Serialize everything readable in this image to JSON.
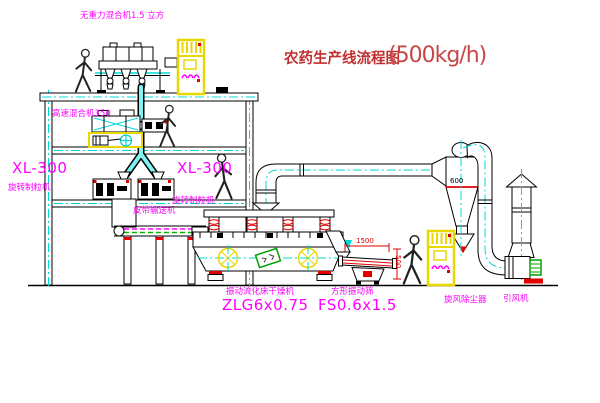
{
  "diagram": {
    "title": {
      "name": "农药生产线流程图",
      "capacity": "(500kg/h)"
    },
    "labels": {
      "gravity_mixer": "无重力混合机1.5 立方",
      "high_speed_mixer": "高速混合机350",
      "granulator_left": {
        "model": "XL-300",
        "name": "旋转制粒机"
      },
      "granulator_right": {
        "model": "XL-300",
        "name": "旋转制粒机"
      },
      "belt_conveyor": "皮带输送机",
      "fluid_bed_dryer": {
        "name": "振动流化床干燥机",
        "model": "ZLG6x0.75"
      },
      "square_sieve": {
        "name": "方形振动筛",
        "model": "FS0.6x1.5"
      },
      "cyclone": "旋风除尘器",
      "induced_draft_fan": "引风机"
    },
    "dimensions": {
      "cyclone_diameter": "600",
      "sieve_length": "1500",
      "sieve_height": "500"
    },
    "colors": {
      "label_magenta": "#FF00FF",
      "title_red": "#C03030",
      "centerline_cyan": "#00D8D8",
      "cabinet_yellow": "#E8D800",
      "accent_red": "#EE0000",
      "belt_green": "#00B800",
      "motor_green": "#00A000"
    }
  }
}
